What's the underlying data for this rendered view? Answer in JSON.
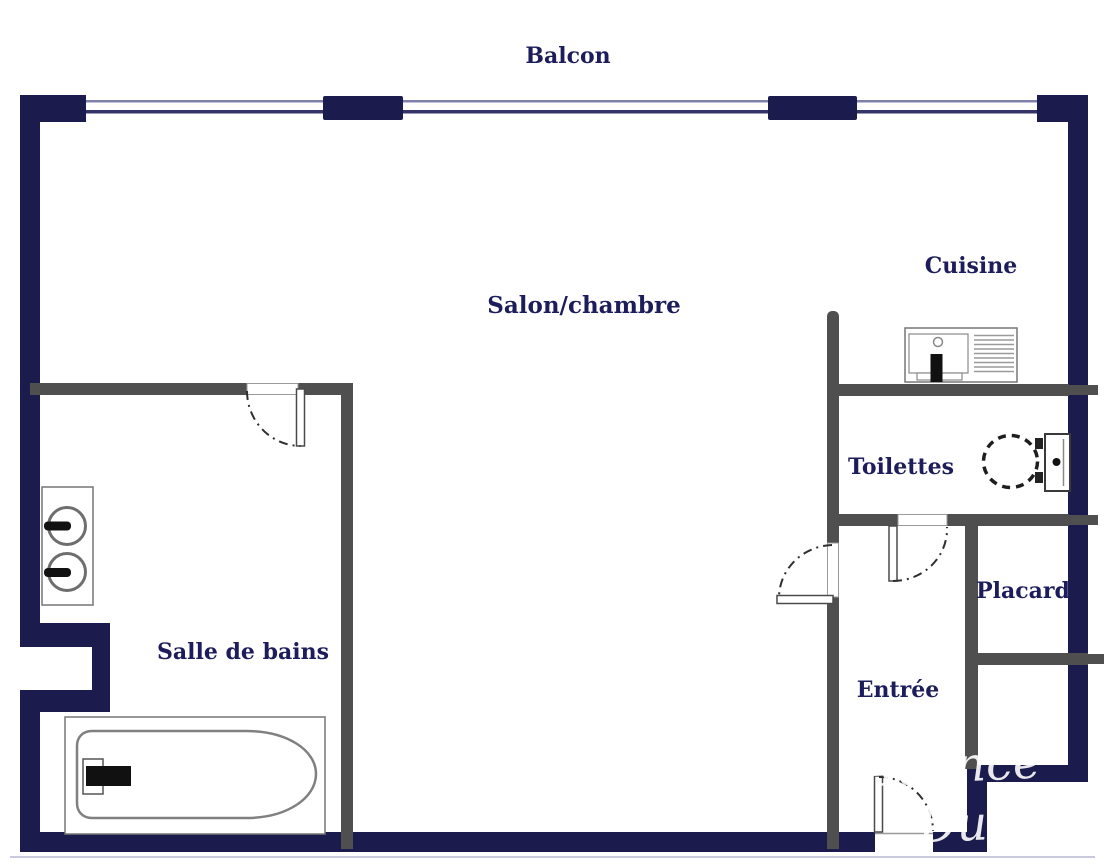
{
  "plan": {
    "labels": {
      "balcon": "Balcon",
      "salon_chambre": "Salon/chambre",
      "cuisine": "Cuisine",
      "toilettes": "Toilettes",
      "placard": "Placard",
      "entree": "Entrée",
      "salle_de_bains": "Salle de bains"
    },
    "watermark": {
      "line1": "Agence",
      "line2": "Dupleix"
    },
    "colors": {
      "wall_navy": "#1b1b4d",
      "wall_gray": "#4f4f4f",
      "label_color": "#1d1d5c",
      "watermark_color": "rgba(255,255,255,0.9)",
      "window_line_light": "#8080ad",
      "window_line_dark": "#34346b",
      "bottom_artifact_line": "#cacade"
    }
  }
}
